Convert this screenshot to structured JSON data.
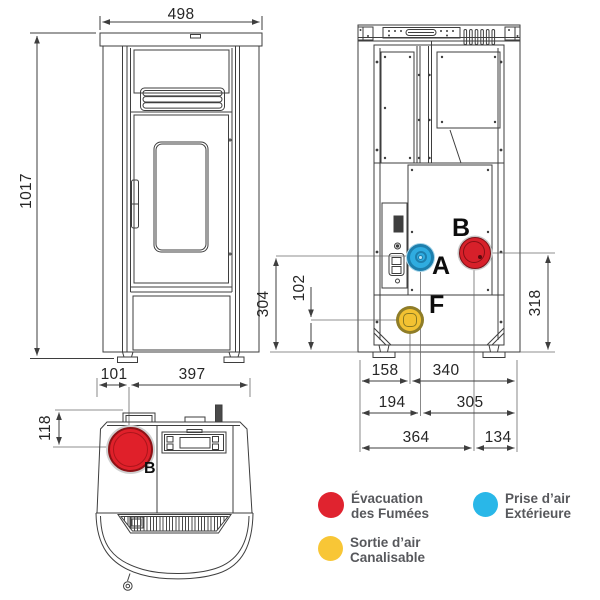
{
  "dimensions": {
    "front_width": "498",
    "front_height": "1017",
    "back_a_height": "304",
    "back_f_height": "102",
    "back_b_height": "318",
    "back_row1_left": "158",
    "back_row1_right": "340",
    "back_row2_left": "194",
    "back_row2_right": "305",
    "back_row3_left": "364",
    "back_row3_right": "134",
    "top_offset_left": "101",
    "top_offset_right": "397",
    "top_depth": "118"
  },
  "ports": {
    "a_label": "A",
    "b_label": "B",
    "f_label": "F",
    "top_b_label": "B",
    "a_color": "#2face0",
    "b_color": "#d7202a",
    "f_color": "#f2c232"
  },
  "legend": {
    "items": [
      {
        "color": "#e0232f",
        "line1": "Évacuation",
        "line2": "des Fumées"
      },
      {
        "color": "#29b7e8",
        "line1": "Prise d’air",
        "line2": "Extérieure"
      },
      {
        "color": "#f8c636",
        "line1": "Sortie d’air",
        "line2": "Canalisable"
      }
    ]
  }
}
